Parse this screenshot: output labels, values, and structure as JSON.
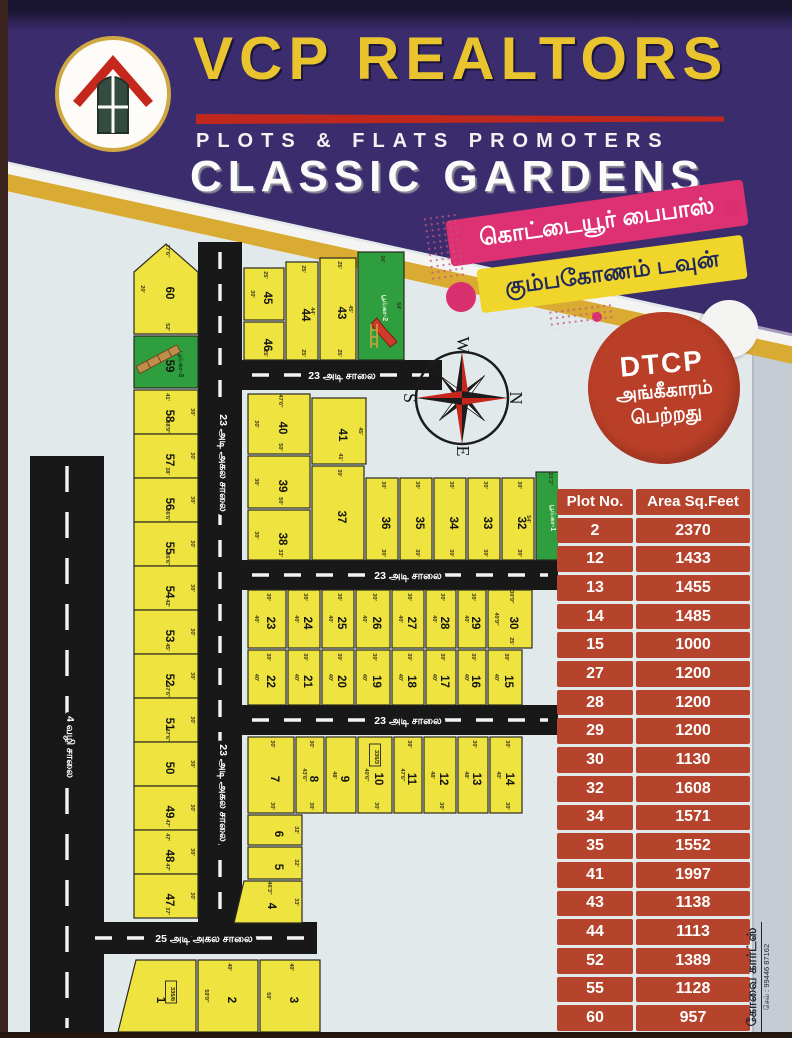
{
  "header": {
    "brand": "VCP REALTORS",
    "tagline": "PLOTS & FLATS PROMOTERS",
    "project": "CLASSIC GARDENS"
  },
  "banners": {
    "pink_label": "கொட்டையூர் பைபாஸ்",
    "yellow_label": "கும்பகோணம் டவுன்"
  },
  "badge": {
    "title": "DTCP",
    "line2": "அங்கீகாரம்",
    "line3": "பெற்றது"
  },
  "compass": {
    "top": "W",
    "right": "N",
    "left": "S",
    "bottom": "E"
  },
  "contact": {
    "name": "கோவை கார்ட்ஸ்",
    "phone": "செல் : 99446 87162"
  },
  "area_table": {
    "headers": [
      "Plot No.",
      "Area Sq.Feet"
    ],
    "rows": [
      [
        "2",
        "2370"
      ],
      [
        "12",
        "1433"
      ],
      [
        "13",
        "1455"
      ],
      [
        "14",
        "1485"
      ],
      [
        "15",
        "1000"
      ],
      [
        "27",
        "1200"
      ],
      [
        "28",
        "1200"
      ],
      [
        "29",
        "1200"
      ],
      [
        "30",
        "1130"
      ],
      [
        "32",
        "1608"
      ],
      [
        "34",
        "1571"
      ],
      [
        "35",
        "1552"
      ],
      [
        "41",
        "1997"
      ],
      [
        "43",
        "1138"
      ],
      [
        "44",
        "1113"
      ],
      [
        "52",
        "1389"
      ],
      [
        "55",
        "1128"
      ],
      [
        "60",
        "957"
      ]
    ]
  },
  "colors": {
    "plot_yellow": "#eee33f",
    "park_green": "#2f9e3e",
    "road_black": "#181818",
    "plot_stroke": "#2a2a20",
    "dash_white": "#f4f4f4",
    "table_red": "#b6432b",
    "badge_red": "#ba3f28",
    "banner_pink": "#dd3173",
    "banner_yellow": "#f0d52b",
    "header_purple": "#3b2c6d",
    "gold": "#d9ab33"
  },
  "map": {
    "roads": [
      {
        "x": 22,
        "y": 228,
        "w": 74,
        "h": 582,
        "dir": "v",
        "dash": "26 20"
      },
      {
        "x": 190,
        "y": 14,
        "w": 44,
        "h": 684,
        "dir": "v",
        "dash": "17 15"
      },
      {
        "x": 234,
        "y": 132,
        "w": 200,
        "h": 30,
        "dir": "h",
        "dash": "17 15"
      },
      {
        "x": 234,
        "y": 332,
        "w": 316,
        "h": 30,
        "dir": "h",
        "dash": "17 15"
      },
      {
        "x": 234,
        "y": 477,
        "w": 316,
        "h": 30,
        "dir": "h",
        "dash": "17 15"
      },
      {
        "x": 77,
        "y": 694,
        "w": 232,
        "h": 32,
        "dir": "h",
        "dash": "17 15"
      }
    ],
    "road_labels": [
      {
        "text": "4 வழி சாலை",
        "x": 59,
        "y": 519,
        "rot": 90
      },
      {
        "text": "23 அடி அகல சாலை",
        "x": 212,
        "y": 235,
        "rot": 90
      },
      {
        "text": "23 அடி அகல சாலை",
        "x": 212,
        "y": 565,
        "rot": 90
      },
      {
        "text": "23 அடி சாலை",
        "x": 334,
        "y": 151,
        "rot": 0
      },
      {
        "text": "23 அடி சாலை",
        "x": 400,
        "y": 351,
        "rot": 0
      },
      {
        "text": "23 அடி சாலை",
        "x": 400,
        "y": 496,
        "rot": 0
      },
      {
        "text": "25 அடி அகல சாலை",
        "x": 196,
        "y": 714,
        "rot": 0
      }
    ],
    "plots": [
      {
        "n": "60",
        "pts": "126,44 158,16 190,44 190,106 126,106",
        "dims": [
          {
            "s": "t",
            "v": "27'6\""
          },
          {
            "s": "l",
            "v": "20'"
          },
          {
            "s": "b",
            "v": "52'"
          }
        ]
      },
      {
        "n": "59",
        "x": 126,
        "y": 108,
        "w": 64,
        "h": 52,
        "park": "பூங்கா-3",
        "slide": "tan"
      },
      {
        "n": "58",
        "x": 126,
        "y": 162,
        "w": 64,
        "h": 44,
        "dims": [
          {
            "s": "t",
            "v": "41'"
          },
          {
            "s": "r",
            "v": "30'"
          },
          {
            "s": "b",
            "v": "38'9\""
          }
        ]
      },
      {
        "n": "57",
        "x": 126,
        "y": 206,
        "w": 64,
        "h": 44,
        "dims": [
          {
            "s": "r",
            "v": "30'"
          },
          {
            "s": "b",
            "v": "38'"
          }
        ]
      },
      {
        "n": "56",
        "x": 126,
        "y": 250,
        "w": 64,
        "h": 44,
        "dims": [
          {
            "s": "r",
            "v": "30'"
          },
          {
            "s": "b",
            "v": "36'6\""
          }
        ]
      },
      {
        "n": "55",
        "x": 126,
        "y": 294,
        "w": 64,
        "h": 44,
        "dims": [
          {
            "s": "r",
            "v": "30'"
          },
          {
            "s": "b",
            "v": "36'6\""
          }
        ]
      },
      {
        "n": "54",
        "x": 126,
        "y": 338,
        "w": 64,
        "h": 44,
        "dims": [
          {
            "s": "r",
            "v": "30'"
          },
          {
            "s": "b",
            "v": "42'"
          }
        ]
      },
      {
        "n": "53",
        "x": 126,
        "y": 382,
        "w": 64,
        "h": 44,
        "dims": [
          {
            "s": "r",
            "v": "30'"
          },
          {
            "s": "b",
            "v": "45'"
          }
        ]
      },
      {
        "n": "52",
        "x": 126,
        "y": 426,
        "w": 64,
        "h": 44,
        "dims": [
          {
            "s": "r",
            "v": "30'"
          },
          {
            "s": "b",
            "v": "47'6\""
          }
        ]
      },
      {
        "n": "51",
        "x": 126,
        "y": 470,
        "w": 64,
        "h": 44,
        "dims": [
          {
            "s": "r",
            "v": "30'"
          },
          {
            "s": "b",
            "v": "47'6\""
          }
        ]
      },
      {
        "n": "50",
        "x": 126,
        "y": 514,
        "w": 64,
        "h": 44,
        "dims": [
          {
            "s": "r",
            "v": "30'"
          }
        ]
      },
      {
        "n": "49",
        "x": 126,
        "y": 558,
        "w": 64,
        "h": 44,
        "dims": [
          {
            "s": "r",
            "v": "30'"
          },
          {
            "s": "b",
            "v": "47'"
          }
        ]
      },
      {
        "n": "48",
        "x": 126,
        "y": 602,
        "w": 64,
        "h": 44,
        "dims": [
          {
            "s": "t",
            "v": "47'"
          },
          {
            "s": "r",
            "v": "30'"
          },
          {
            "s": "b",
            "v": "47'"
          }
        ]
      },
      {
        "n": "47",
        "x": 126,
        "y": 646,
        "w": 64,
        "h": 44,
        "dims": [
          {
            "s": "r",
            "v": "30'"
          },
          {
            "s": "b",
            "v": "37'"
          }
        ]
      },
      {
        "n": "45",
        "x": 236,
        "y": 40,
        "w": 40,
        "h": 52,
        "dims": [
          {
            "s": "t",
            "v": "25'"
          },
          {
            "s": "l",
            "v": "30'"
          }
        ]
      },
      {
        "n": "46",
        "x": 236,
        "y": 94,
        "w": 40,
        "h": 38,
        "dims": [
          {
            "s": "b",
            "v": "25'"
          }
        ]
      },
      {
        "n": "44",
        "x": 278,
        "y": 34,
        "w": 32,
        "h": 98,
        "dims": [
          {
            "s": "t",
            "v": "25'"
          },
          {
            "s": "r",
            "v": "44'"
          },
          {
            "s": "b",
            "v": "25'"
          }
        ]
      },
      {
        "n": "43",
        "x": 312,
        "y": 30,
        "w": 36,
        "h": 102,
        "dims": [
          {
            "s": "t",
            "v": "25'"
          },
          {
            "s": "r",
            "v": "45'"
          },
          {
            "s": "b",
            "v": "25'"
          }
        ]
      },
      {
        "n": "",
        "x": 350,
        "y": 24,
        "w": 46,
        "h": 108,
        "park": "பூங்கா-2",
        "slide": "red",
        "dims": [
          {
            "s": "t",
            "v": "26'"
          },
          {
            "s": "r",
            "v": "54'"
          }
        ]
      },
      {
        "n": "40",
        "x": 240,
        "y": 166,
        "w": 62,
        "h": 60,
        "dims": [
          {
            "s": "t",
            "v": "47'6\""
          },
          {
            "s": "l",
            "v": "30'"
          },
          {
            "s": "b",
            "v": "50'"
          }
        ]
      },
      {
        "n": "41",
        "x": 304,
        "y": 170,
        "w": 54,
        "h": 66,
        "dims": [
          {
            "s": "r",
            "v": "45'"
          },
          {
            "s": "b",
            "v": "41'"
          }
        ]
      },
      {
        "n": "39",
        "x": 240,
        "y": 228,
        "w": 62,
        "h": 52,
        "dims": [
          {
            "s": "l",
            "v": "30'"
          },
          {
            "s": "b",
            "v": "50'"
          }
        ]
      },
      {
        "n": "38",
        "x": 240,
        "y": 282,
        "w": 62,
        "h": 50,
        "dims": [
          {
            "s": "l",
            "v": "30'"
          },
          {
            "s": "b",
            "v": "33'"
          }
        ]
      },
      {
        "n": "37",
        "x": 304,
        "y": 238,
        "w": 52,
        "h": 94,
        "dims": [
          {
            "s": "t",
            "v": "30'"
          }
        ]
      },
      {
        "n": "36",
        "x": 358,
        "y": 250,
        "w": 32,
        "h": 82,
        "dims": [
          {
            "s": "t",
            "v": "30'"
          },
          {
            "s": "b",
            "v": "30'"
          }
        ]
      },
      {
        "n": "35",
        "x": 392,
        "y": 250,
        "w": 32,
        "h": 82,
        "dims": [
          {
            "s": "t",
            "v": "30'"
          },
          {
            "s": "b",
            "v": "30'"
          }
        ]
      },
      {
        "n": "34",
        "x": 426,
        "y": 250,
        "w": 32,
        "h": 82,
        "dims": [
          {
            "s": "t",
            "v": "30'"
          },
          {
            "s": "b",
            "v": "30'"
          }
        ]
      },
      {
        "n": "33",
        "x": 460,
        "y": 250,
        "w": 32,
        "h": 82,
        "dims": [
          {
            "s": "t",
            "v": "30'"
          },
          {
            "s": "b",
            "v": "30'"
          }
        ]
      },
      {
        "n": "32",
        "x": 494,
        "y": 250,
        "w": 32,
        "h": 82,
        "dims": [
          {
            "s": "t",
            "v": "30'"
          },
          {
            "s": "r",
            "v": "54'"
          },
          {
            "s": "b",
            "v": "30'"
          }
        ]
      },
      {
        "n": "",
        "x": 528,
        "y": 244,
        "w": 26,
        "h": 88,
        "park": "பூங்கா-1",
        "dims": [
          {
            "s": "t",
            "v": "21'3\""
          }
        ]
      },
      {
        "n": "23",
        "x": 240,
        "y": 362,
        "w": 38,
        "h": 58,
        "dims": [
          {
            "s": "t",
            "v": "30'"
          },
          {
            "s": "l",
            "v": "40'"
          }
        ]
      },
      {
        "n": "24",
        "x": 280,
        "y": 362,
        "w": 32,
        "h": 58,
        "dims": [
          {
            "s": "t",
            "v": "30'"
          },
          {
            "s": "l",
            "v": "40'"
          }
        ]
      },
      {
        "n": "25",
        "x": 314,
        "y": 362,
        "w": 32,
        "h": 58,
        "dims": [
          {
            "s": "t",
            "v": "30'"
          },
          {
            "s": "l",
            "v": "40'"
          }
        ]
      },
      {
        "n": "26",
        "x": 348,
        "y": 362,
        "w": 34,
        "h": 58,
        "dims": [
          {
            "s": "t",
            "v": "30'"
          },
          {
            "s": "l",
            "v": "40'"
          }
        ]
      },
      {
        "n": "27",
        "x": 384,
        "y": 362,
        "w": 32,
        "h": 58,
        "dims": [
          {
            "s": "t",
            "v": "30'"
          },
          {
            "s": "l",
            "v": "40'"
          }
        ]
      },
      {
        "n": "28",
        "x": 418,
        "y": 362,
        "w": 30,
        "h": 58,
        "dims": [
          {
            "s": "t",
            "v": "30'"
          },
          {
            "s": "l",
            "v": "40'"
          }
        ]
      },
      {
        "n": "29",
        "x": 450,
        "y": 362,
        "w": 28,
        "h": 58,
        "dims": [
          {
            "s": "t",
            "v": "30'"
          },
          {
            "s": "l",
            "v": "40'"
          }
        ]
      },
      {
        "n": "30",
        "x": 480,
        "y": 362,
        "w": 44,
        "h": 58,
        "dims": [
          {
            "s": "t",
            "v": "30'9\""
          },
          {
            "s": "l",
            "v": "40'9\""
          },
          {
            "s": "b",
            "v": "25'"
          }
        ]
      },
      {
        "n": "22",
        "x": 240,
        "y": 422,
        "w": 38,
        "h": 55,
        "dims": [
          {
            "s": "t",
            "v": "30'"
          },
          {
            "s": "l",
            "v": "40'"
          }
        ]
      },
      {
        "n": "21",
        "x": 280,
        "y": 422,
        "w": 32,
        "h": 55,
        "dims": [
          {
            "s": "t",
            "v": "30'"
          },
          {
            "s": "l",
            "v": "40'"
          }
        ]
      },
      {
        "n": "20",
        "x": 314,
        "y": 422,
        "w": 32,
        "h": 55,
        "dims": [
          {
            "s": "t",
            "v": "30'"
          },
          {
            "s": "l",
            "v": "40'"
          }
        ]
      },
      {
        "n": "19",
        "x": 348,
        "y": 422,
        "w": 34,
        "h": 55,
        "dims": [
          {
            "s": "t",
            "v": "30'"
          },
          {
            "s": "l",
            "v": "40'"
          }
        ]
      },
      {
        "n": "18",
        "x": 384,
        "y": 422,
        "w": 32,
        "h": 55,
        "dims": [
          {
            "s": "t",
            "v": "30'"
          },
          {
            "s": "l",
            "v": "40'"
          }
        ]
      },
      {
        "n": "17",
        "x": 418,
        "y": 422,
        "w": 30,
        "h": 55,
        "dims": [
          {
            "s": "t",
            "v": "30'"
          },
          {
            "s": "l",
            "v": "40'"
          }
        ]
      },
      {
        "n": "16",
        "x": 450,
        "y": 422,
        "w": 28,
        "h": 55,
        "dims": [
          {
            "s": "t",
            "v": "30'"
          },
          {
            "s": "l",
            "v": "40'"
          }
        ]
      },
      {
        "n": "15",
        "x": 480,
        "y": 422,
        "w": 34,
        "h": 55,
        "dims": [
          {
            "s": "t",
            "v": "30'"
          },
          {
            "s": "l",
            "v": "40'"
          }
        ]
      },
      {
        "n": "7",
        "x": 240,
        "y": 509,
        "w": 46,
        "h": 76,
        "dims": [
          {
            "s": "t",
            "v": "30'"
          },
          {
            "s": "b",
            "v": "30'"
          }
        ]
      },
      {
        "n": "8",
        "x": 288,
        "y": 509,
        "w": 28,
        "h": 76,
        "dims": [
          {
            "s": "t",
            "v": "30'"
          },
          {
            "s": "l",
            "v": "43'6\""
          },
          {
            "s": "b",
            "v": "30'"
          }
        ]
      },
      {
        "n": "9",
        "x": 318,
        "y": 509,
        "w": 30,
        "h": 76,
        "dims": [
          {
            "s": "l",
            "v": "48'"
          }
        ]
      },
      {
        "n": "10",
        "x": 350,
        "y": 509,
        "w": 34,
        "h": 76,
        "tag": "336/3",
        "dims": [
          {
            "s": "l",
            "v": "40'6\""
          },
          {
            "s": "b",
            "v": "30'"
          }
        ]
      },
      {
        "n": "11",
        "x": 386,
        "y": 509,
        "w": 28,
        "h": 76,
        "dims": [
          {
            "s": "t",
            "v": "30'"
          },
          {
            "s": "l",
            "v": "47'6\""
          }
        ]
      },
      {
        "n": "12",
        "x": 416,
        "y": 509,
        "w": 32,
        "h": 76,
        "dims": [
          {
            "s": "l",
            "v": "48'"
          },
          {
            "s": "b",
            "v": "30'"
          }
        ]
      },
      {
        "n": "13",
        "x": 450,
        "y": 509,
        "w": 30,
        "h": 76,
        "dims": [
          {
            "s": "t",
            "v": "30'"
          },
          {
            "s": "l",
            "v": "48'"
          }
        ]
      },
      {
        "n": "14",
        "x": 482,
        "y": 509,
        "w": 32,
        "h": 76,
        "dims": [
          {
            "s": "t",
            "v": "30'"
          },
          {
            "s": "l",
            "v": "40'"
          },
          {
            "s": "b",
            "v": "30'"
          }
        ]
      },
      {
        "n": "6",
        "x": 240,
        "y": 587,
        "w": 54,
        "h": 30,
        "dims": [
          {
            "s": "r",
            "v": "32'"
          }
        ]
      },
      {
        "n": "5",
        "x": 240,
        "y": 619,
        "w": 54,
        "h": 32,
        "dims": [
          {
            "s": "r",
            "v": "32'"
          }
        ]
      },
      {
        "n": "4",
        "pts": "236,653 294,653 294,695 226,695",
        "dims": [
          {
            "s": "t",
            "v": "46'3\""
          },
          {
            "s": "r",
            "v": "33'"
          }
        ]
      },
      {
        "n": "1",
        "pts": "128,732 188,732 188,804 110,804",
        "tag": "336/8"
      },
      {
        "n": "2",
        "x": 190,
        "y": 732,
        "w": 60,
        "h": 72,
        "dims": [
          {
            "s": "t",
            "v": "40'"
          },
          {
            "s": "l",
            "v": "59'9\""
          }
        ]
      },
      {
        "n": "3",
        "x": 252,
        "y": 732,
        "w": 60,
        "h": 72,
        "dims": [
          {
            "s": "t",
            "v": "40'"
          },
          {
            "s": "l",
            "v": "59'"
          }
        ]
      }
    ]
  }
}
